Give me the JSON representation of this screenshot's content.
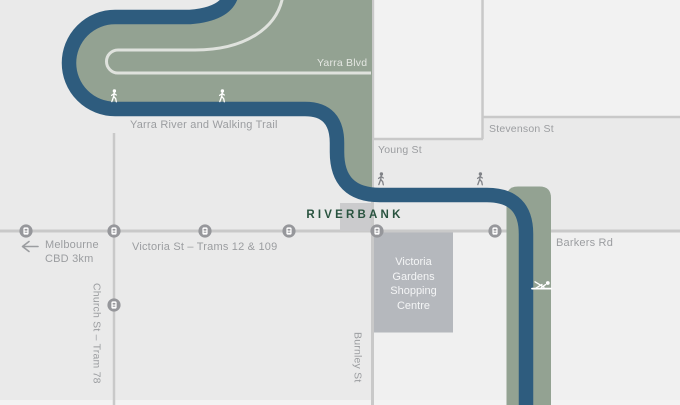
{
  "title": "Riverbank location map",
  "colors": {
    "bg": "#eaeaea",
    "block": "#f2f2f2",
    "block2": "#f0f0f0",
    "block3": "#f3f3f3",
    "road": "#c9c9c9",
    "blvd": "#dfe2dd",
    "green": "#93a292",
    "river": "#2e5c7e",
    "square": "#cbcbcd",
    "box": "#b5b8bd",
    "stop": "#96979b",
    "text": "#9b9da0",
    "text-green": "#e4e7e2",
    "brand": "#2a5440",
    "walker": "#808287",
    "white": "#ffffff"
  },
  "labels": {
    "yarra_blvd": "Yarra Blvd",
    "walking_trail": "Yarra River and Walking Trail",
    "stevenson_st": "Stevenson St",
    "young_st": "Young St",
    "brand": "RIVERBANK",
    "melbourne_cbd": [
      "Melbourne",
      "CBD 3km"
    ],
    "victoria_st": "Victoria St – Trams 12 & 109",
    "church_st": "Church St – Tram 78",
    "shopping_centre": [
      "Victoria",
      "Gardens",
      "Shopping",
      "Centre"
    ],
    "burnley_st": "Burnley St",
    "barkers_rd": "Barkers Rd"
  },
  "icons": {
    "tram_stop": "tram-stop-icon",
    "walker": "pedestrian-icon",
    "rower": "rower-icon",
    "cbd_arrow": "left-arrow-icon"
  },
  "map": {
    "tram_stop_count_victoria_st": 6,
    "tram_stop_count_church_st": 1,
    "walker_count_trail": 2,
    "walker_count_young_st": 2
  }
}
